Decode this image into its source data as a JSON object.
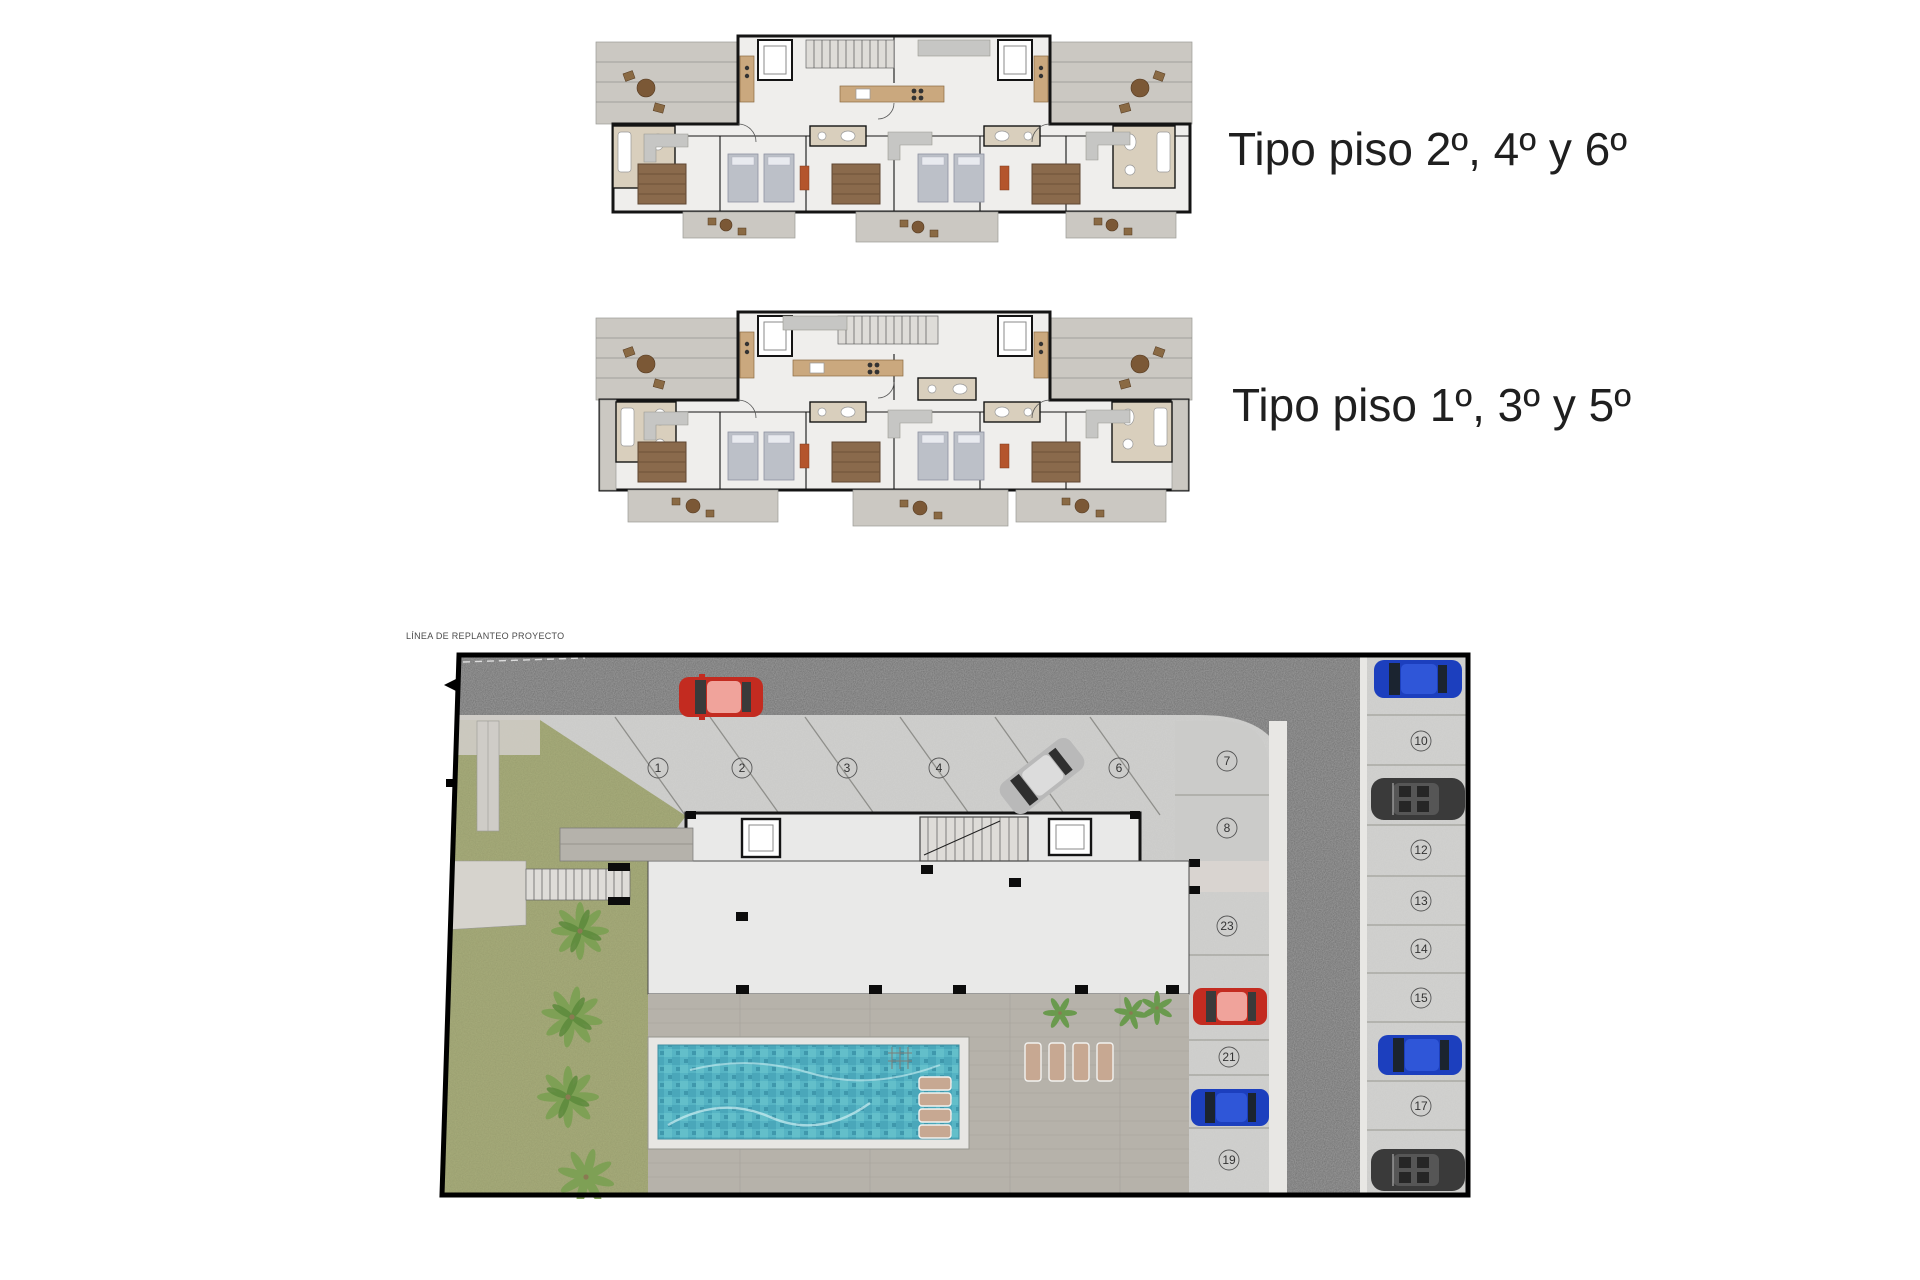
{
  "page": {
    "background": "#ffffff"
  },
  "floor_plans": {
    "upper": {
      "label": "Tipo piso 2º, 4º y 6º"
    },
    "lower": {
      "label": "Tipo piso 1º, 3º y 5º"
    }
  },
  "site_plan": {
    "boundary_label": "LÍNEA DE REPLANTEO PROYECTO",
    "parking_spaces": {
      "s1": "1",
      "s2": "2",
      "s3": "3",
      "s4": "4",
      "s6": "6",
      "s7": "7",
      "s8": "8",
      "s10": "10",
      "s12": "12",
      "s13": "13",
      "s14": "14",
      "s15": "15",
      "s17": "17",
      "s19": "19",
      "s21": "21",
      "s23": "23"
    },
    "cars": [
      {
        "color": "red"
      },
      {
        "color": "silver"
      },
      {
        "color": "blue"
      },
      {
        "color": "dark-grey"
      },
      {
        "color": "red"
      },
      {
        "color": "blue"
      },
      {
        "color": "blue"
      },
      {
        "color": "dark-grey"
      }
    ],
    "features": [
      "swimming-pool",
      "sun-loungers",
      "palm-trees",
      "lawn",
      "access-road",
      "parking",
      "building-footprint",
      "entrance-stairs"
    ]
  },
  "colors": {
    "label_text": "#1f1f1f",
    "asphalt": "#6e6e6e",
    "concrete": "#c9c9c7",
    "lawn": "#a9ae7c",
    "pool_water": "#56b4c4",
    "deck": "#b6b2aa",
    "terrace": "#cbc8c2",
    "building": "#e9e9e8",
    "wall": "#141414",
    "car_red": "#c32b20",
    "car_blue": "#1c3fbe",
    "car_silver": "#b9b9b9",
    "car_dark": "#3a3a3a"
  }
}
